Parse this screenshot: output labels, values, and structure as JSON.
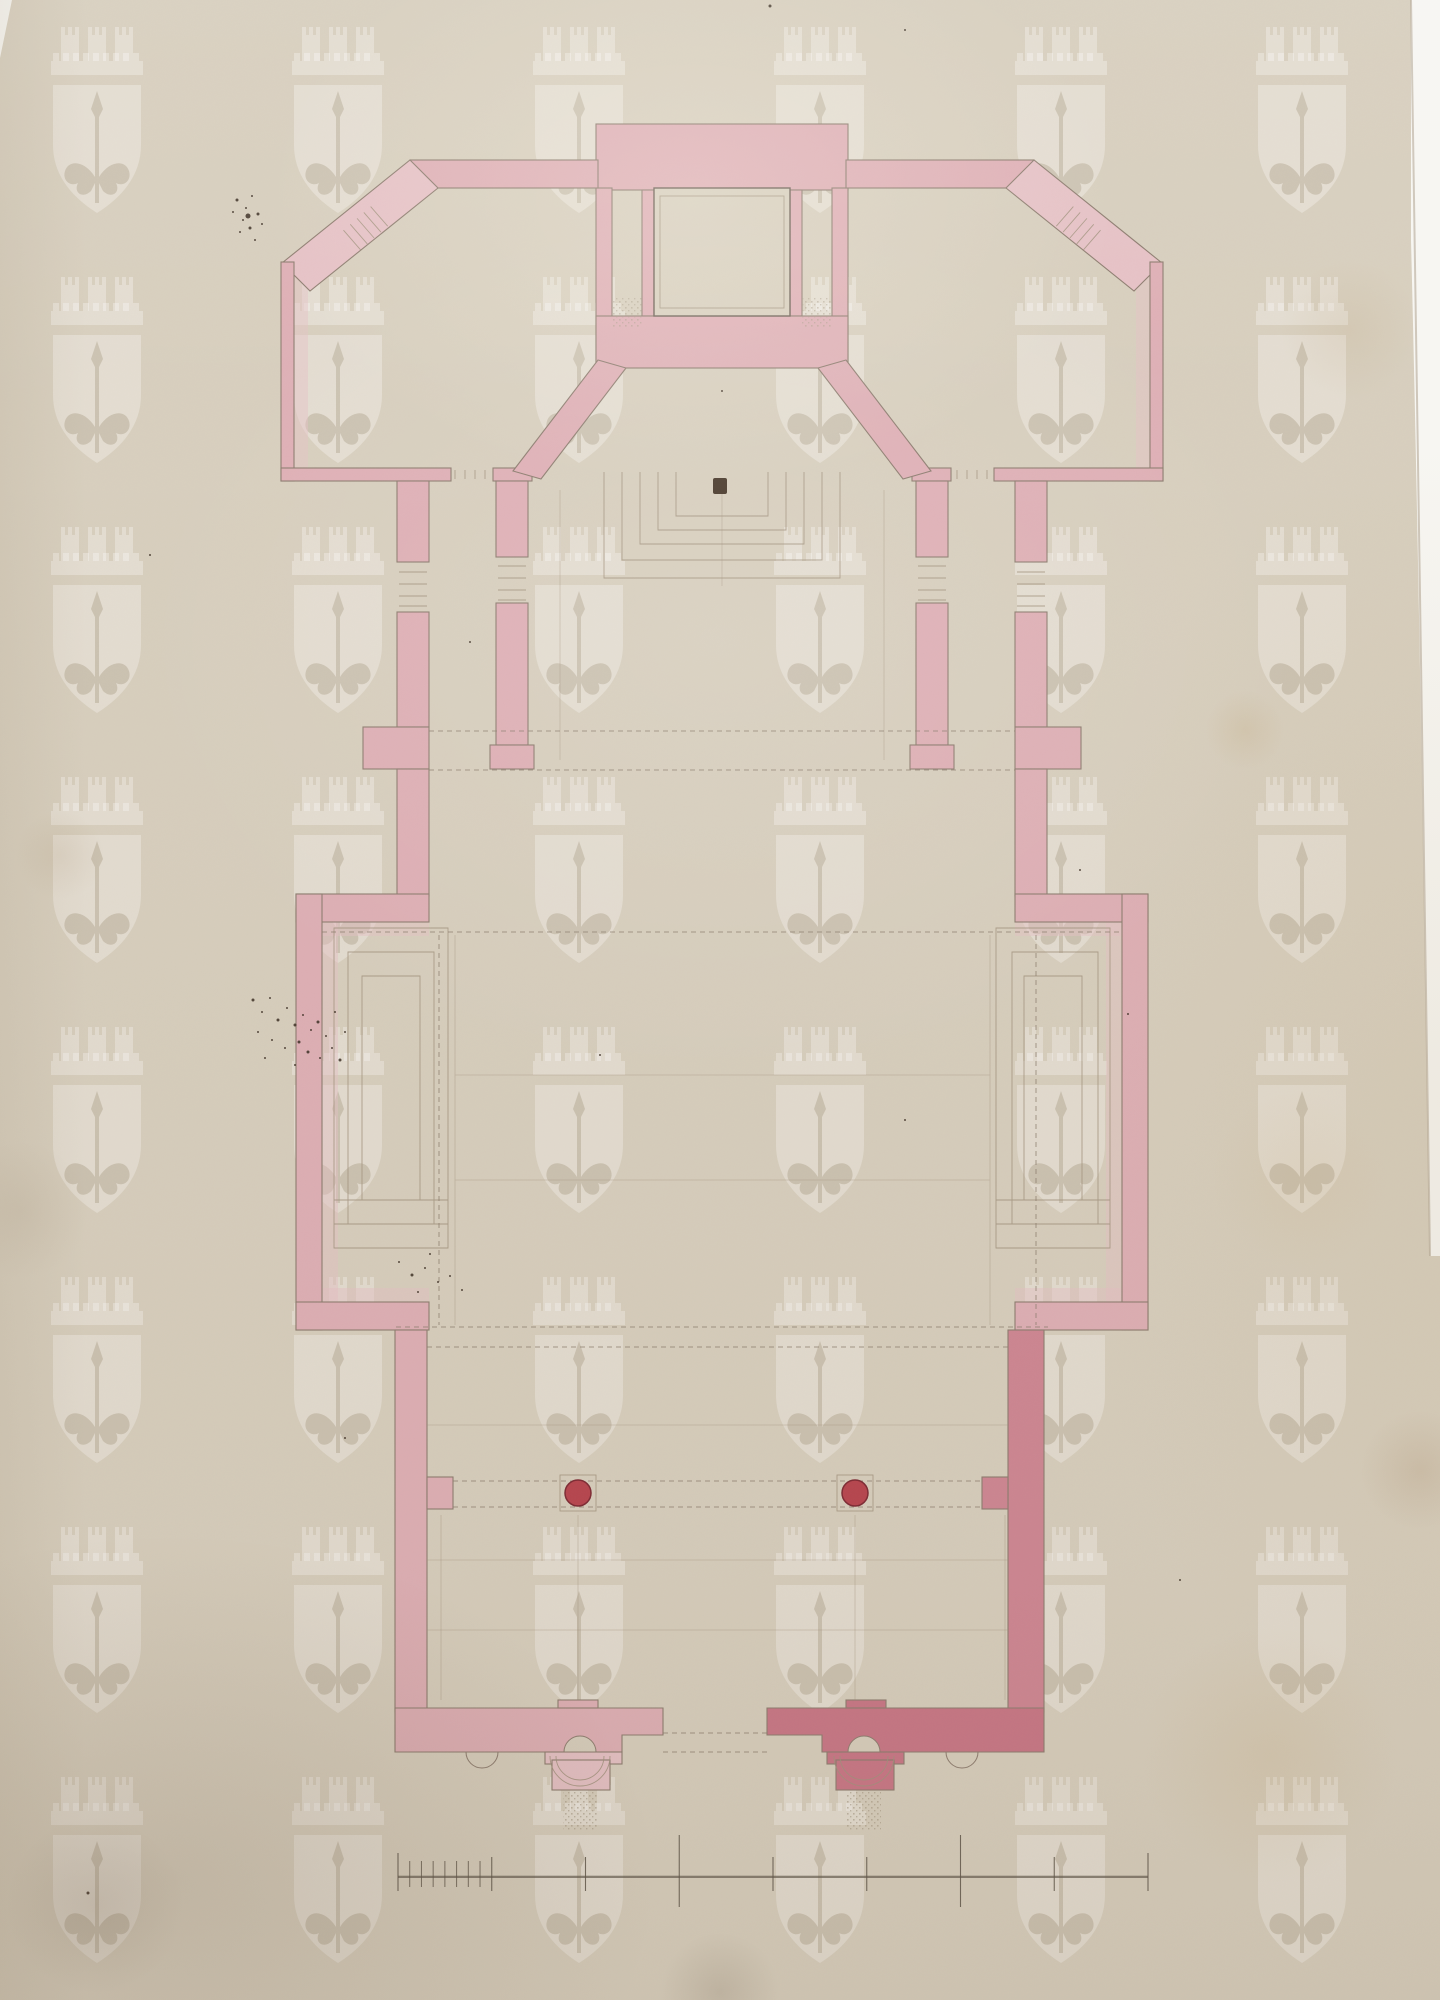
{
  "document": {
    "kind": "scanned architectural drawing",
    "subject": "church ground plan in pencil with pink watercolour wash",
    "visible_text": []
  },
  "palette": {
    "paper": "#d8cfbe",
    "paper_light": "#e2dac9",
    "wash_pink": "#dfb0b6",
    "wash_pink_light": "#e6c2c6",
    "wash_pink_dark": "#cf8794",
    "porch_dark": "#c97787",
    "column_red": "#b8454f",
    "column_red_dark": "#7e2a34",
    "ink_outline": "#8e7d70",
    "pencil": "#a2937f",
    "dashed_line": "#8c7e6d",
    "ink_speck": "#3c2f24",
    "scale_bar_ink": "#5f564a",
    "scan_background": "#f7f6f2",
    "watermark": "rgba(255,255,255,0.30)"
  },
  "watermark": {
    "glyph": "crowned-shield-with-trident-watermark",
    "col_centers": [
      97,
      338,
      579,
      820,
      1061,
      1302
    ],
    "row_tops": [
      27,
      277,
      527,
      777,
      1027,
      1277,
      1527,
      1777
    ],
    "symbol_width": 92,
    "symbol_height": 190
  },
  "nave_columns": {
    "positions": [
      [
        578,
        1493
      ],
      [
        855,
        1493
      ]
    ],
    "radius": 13
  },
  "scale_bar": {
    "y": 1877,
    "x_start": 398,
    "x_end": 1148,
    "major_units": 8,
    "subdivisions_in_first_unit": 8,
    "tall_tick_indexes": [
      3,
      6
    ]
  },
  "stains": [
    {
      "x": 1270,
      "y": 1755,
      "r": 130,
      "color": "rgba(190,160,110,0.16)"
    },
    {
      "x": 1350,
      "y": 330,
      "r": 70,
      "color": "rgba(180,150,105,0.12)"
    },
    {
      "x": 60,
      "y": 855,
      "r": 45,
      "color": "rgba(150,120,80,0.10)"
    },
    {
      "x": 1245,
      "y": 730,
      "r": 40,
      "color": "rgba(190,160,110,0.18)"
    },
    {
      "x": 1420,
      "y": 1470,
      "r": 60,
      "color": "rgba(150,110,70,0.14)"
    },
    {
      "x": 95,
      "y": 1905,
      "r": 90,
      "color": "rgba(90,70,50,0.10)"
    },
    {
      "x": 720,
      "y": 1992,
      "r": 60,
      "color": "rgba(80,60,40,0.12)"
    },
    {
      "x": 20,
      "y": 1210,
      "r": 70,
      "color": "rgba(120,95,65,0.08)"
    },
    {
      "x": 1300,
      "y": 1180,
      "r": 90,
      "color": "rgba(200,170,120,0.10)"
    }
  ],
  "ink_speckles": [
    [
      237,
      200,
      3
    ],
    [
      246,
      208,
      2
    ],
    [
      252,
      196,
      2
    ],
    [
      258,
      214,
      3
    ],
    [
      243,
      220,
      2
    ],
    [
      233,
      212,
      2
    ],
    [
      250,
      228,
      3
    ],
    [
      262,
      224,
      2
    ],
    [
      240,
      232,
      2
    ],
    [
      255,
      240,
      2
    ],
    [
      248,
      216,
      5
    ],
    [
      253,
      1000,
      3
    ],
    [
      262,
      1012,
      2
    ],
    [
      270,
      998,
      2
    ],
    [
      278,
      1020,
      3
    ],
    [
      287,
      1008,
      2
    ],
    [
      295,
      1025,
      3
    ],
    [
      303,
      1015,
      2
    ],
    [
      311,
      1030,
      2
    ],
    [
      318,
      1022,
      3
    ],
    [
      326,
      1036,
      2
    ],
    [
      299,
      1042,
      3
    ],
    [
      285,
      1048,
      2
    ],
    [
      272,
      1040,
      2
    ],
    [
      308,
      1052,
      3
    ],
    [
      320,
      1058,
      2
    ],
    [
      332,
      1048,
      2
    ],
    [
      340,
      1060,
      3
    ],
    [
      258,
      1032,
      2
    ],
    [
      265,
      1058,
      2
    ],
    [
      345,
      1032,
      2
    ],
    [
      295,
      1065,
      2
    ],
    [
      335,
      1012,
      2
    ],
    [
      399,
      1262,
      2
    ],
    [
      412,
      1275,
      3
    ],
    [
      425,
      1268,
      2
    ],
    [
      438,
      1282,
      2
    ],
    [
      418,
      1292,
      2
    ],
    [
      450,
      1276,
      2
    ],
    [
      462,
      1290,
      2
    ],
    [
      430,
      1254,
      2
    ],
    [
      88,
      1893,
      3
    ],
    [
      345,
      1438,
      2
    ],
    [
      1128,
      1014,
      2
    ],
    [
      722,
      391,
      2
    ],
    [
      470,
      642,
      2
    ],
    [
      600,
      1055,
      2
    ],
    [
      1080,
      870,
      2
    ],
    [
      150,
      555,
      2
    ],
    [
      1180,
      1580,
      2
    ],
    [
      905,
      1120,
      2
    ],
    [
      770,
      6,
      3
    ],
    [
      905,
      30,
      2
    ]
  ]
}
